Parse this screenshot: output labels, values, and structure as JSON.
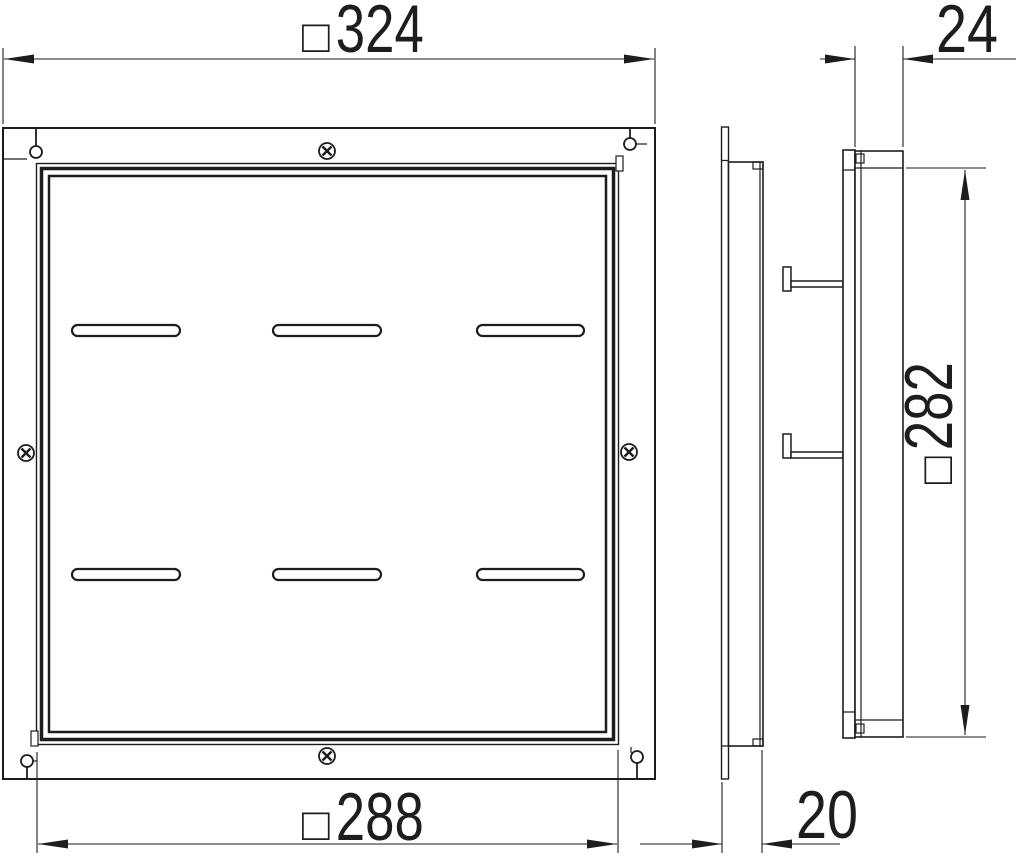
{
  "drawing": {
    "line_color": "#1d1d1b",
    "background": "#ffffff",
    "type": "dimensioned technical drawing, front view and two side views of a square cassette / cover plate"
  },
  "dimensions": {
    "outer_width": {
      "prefix": "□",
      "value": "324"
    },
    "inner_width": {
      "prefix": "□",
      "value": "288"
    },
    "side_height": {
      "prefix": "□",
      "value": "282"
    },
    "depth_right": {
      "value": "24"
    },
    "depth_middle": {
      "value": "20"
    }
  }
}
